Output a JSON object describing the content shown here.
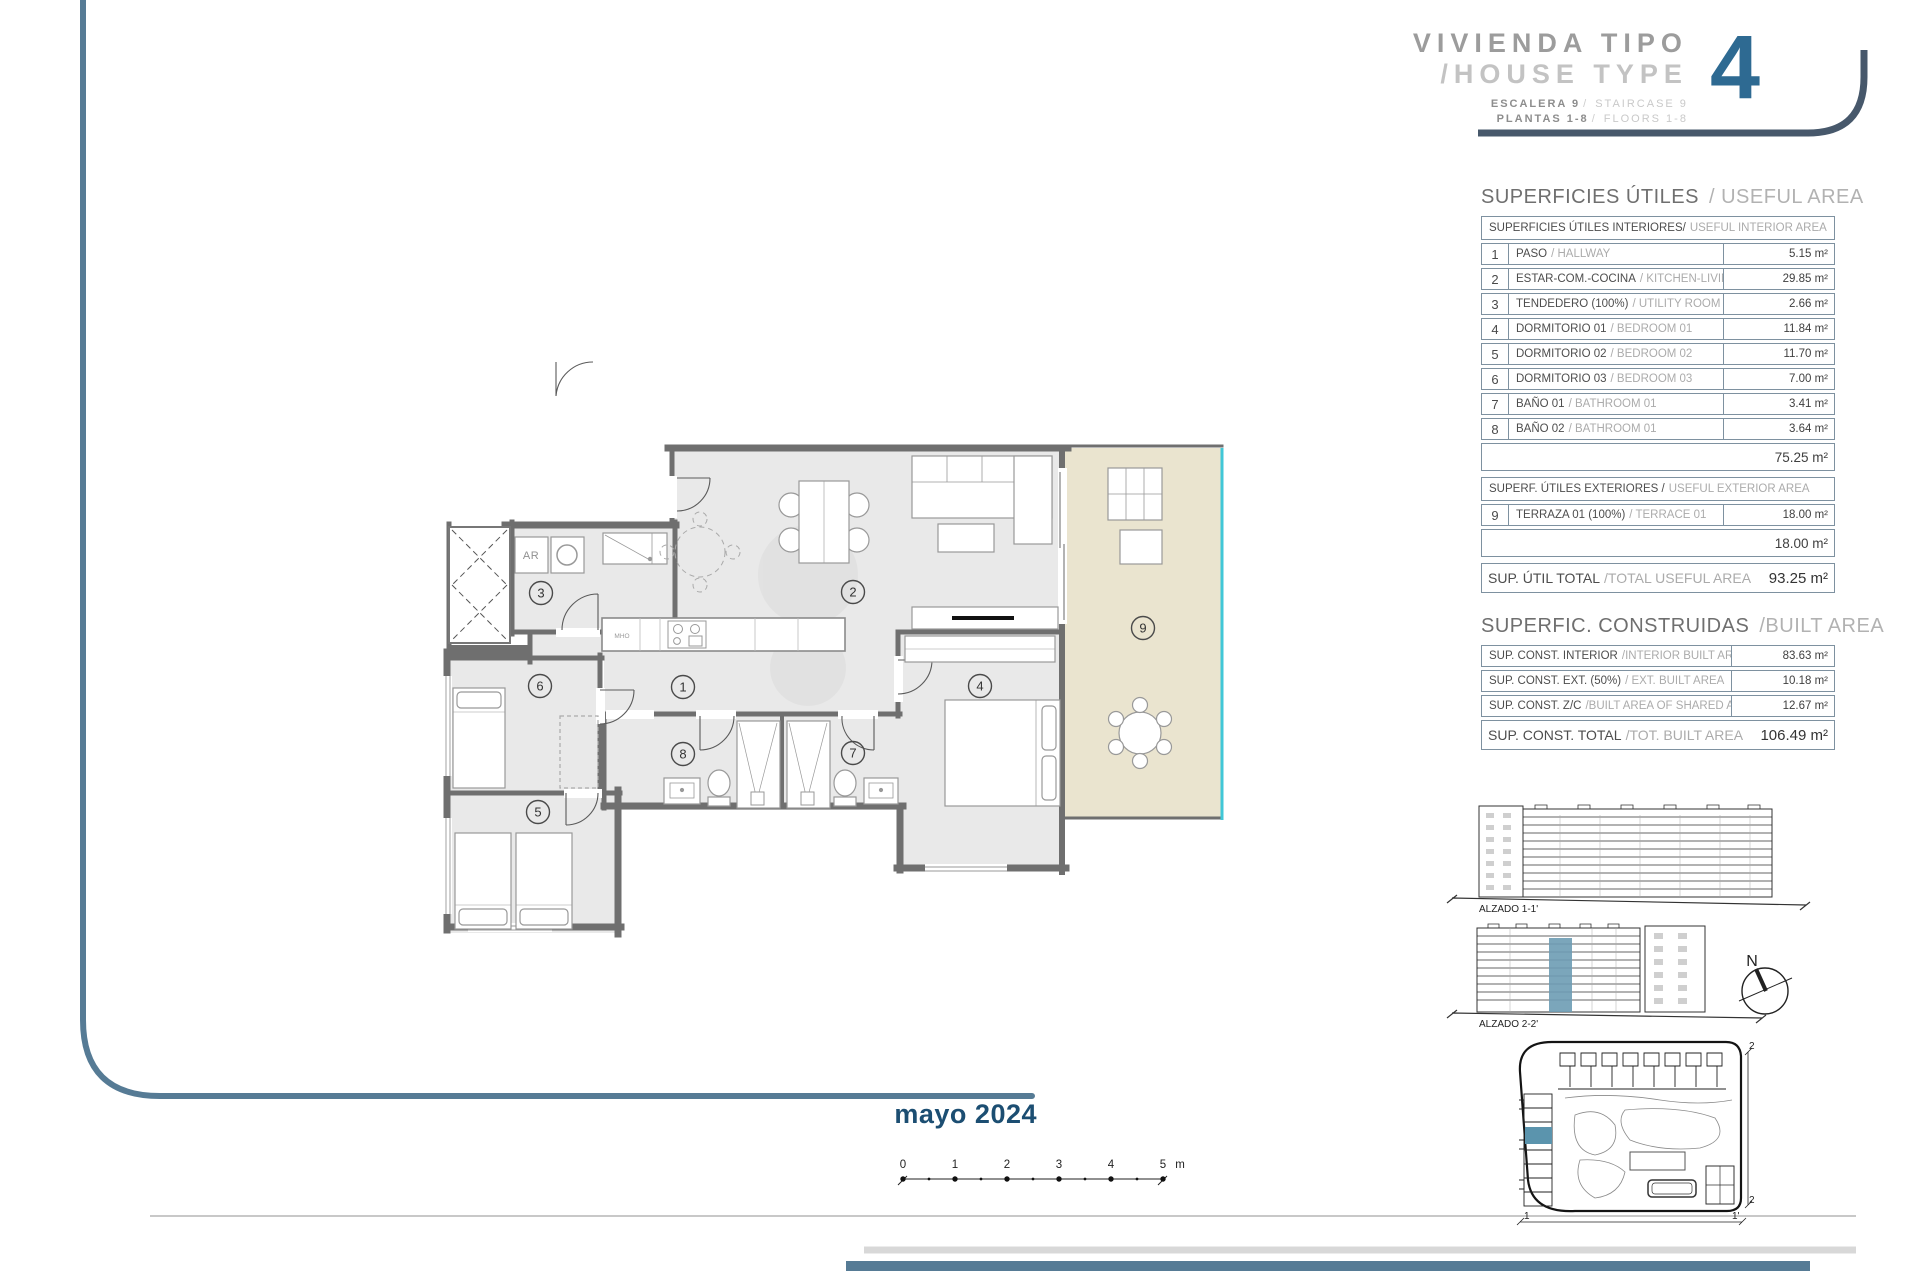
{
  "page": {
    "date": "mayo 2024"
  },
  "title_block": {
    "title_line1": "VIVIENDA TIPO",
    "title_line2": "/HOUSE TYPE",
    "type_number": "4",
    "sub_rows": [
      {
        "es": "ESCALERA 9",
        "en": "STAIRCASE 9"
      },
      {
        "es": "PLANTAS 1-8",
        "en": "FLOORS 1-8"
      }
    ]
  },
  "useful_area": {
    "title_es": "SUPERFICIES ÚTILES ",
    "title_en": "/ USEFUL AREA",
    "interior_header_es": "SUPERFICIES ÚTILES INTERIORES/",
    "interior_header_en": " USEFUL INTERIOR AREA",
    "rows": [
      {
        "num": "1",
        "es": "PASO",
        "en": "/ HALLWAY",
        "value": "5.15 m²"
      },
      {
        "num": "2",
        "es": "ESTAR-COM.-COCINA",
        "en": "/ KITCHEN-LIVING",
        "value": "29.85 m²"
      },
      {
        "num": "3",
        "es": "TENDEDERO (100%)",
        "en": "/ UTILITY ROOM",
        "value": "2.66 m²"
      },
      {
        "num": "4",
        "es": "DORMITORIO 01",
        "en": "/ BEDROOM 01",
        "value": "11.84 m²"
      },
      {
        "num": "5",
        "es": "DORMITORIO 02",
        "en": "/ BEDROOM 02",
        "value": "11.70 m²"
      },
      {
        "num": "6",
        "es": "DORMITORIO 03",
        "en": "/ BEDROOM 03",
        "value": "7.00 m²"
      },
      {
        "num": "7",
        "es": "BAÑO 01",
        "en": "/ BATHROOM 01",
        "value": "3.41 m²"
      },
      {
        "num": "8",
        "es": "BAÑO 02",
        "en": "/ BATHROOM 01",
        "value": "3.64 m²"
      }
    ],
    "interior_subtotal": "75.25 m²",
    "exterior_header_es": "SUPERF. ÚTILES EXTERIORES /",
    "exterior_header_en": " USEFUL EXTERIOR AREA",
    "exterior_rows": [
      {
        "num": "9",
        "es": "TERRAZA 01 (100%)",
        "en": "/ TERRACE 01",
        "value": "18.00 m²"
      }
    ],
    "exterior_subtotal": "18.00 m²",
    "total_es": "SUP. ÚTIL TOTAL",
    "total_en": "/TOTAL USEFUL AREA",
    "total_value": "93.25 m²"
  },
  "built_area": {
    "title_es": "SUPERFIC. CONSTRUIDAS ",
    "title_en": "/BUILT AREA",
    "rows": [
      {
        "es": "SUP. CONST. INTERIOR",
        "en": "/INTERIOR BUILT AREA",
        "value": "83.63 m²"
      },
      {
        "es": "SUP. CONST. EXT. (50%)",
        "en": "/ EXT. BUILT AREA",
        "value": "10.18 m²"
      },
      {
        "es": "SUP. CONST. Z/C",
        "en": "/BUILT AREA OF SHARED AREAS",
        "value": "12.67 m²"
      }
    ],
    "total_es": "SUP. CONST. TOTAL",
    "total_en": "/TOT. BUILT AREA",
    "total_value": "106.49 m²"
  },
  "floor_plan": {
    "room_numbers": [
      "1",
      "2",
      "3",
      "4",
      "5",
      "6",
      "7",
      "8",
      "9"
    ],
    "labels": {
      "closet": "AR",
      "kitchen_small": "MHO"
    },
    "floor_color": "#e9e9e9",
    "terrace_color": "#eae4cf",
    "wall_color": "#6f6f6f",
    "terrace_edge_color": "#41c7d7"
  },
  "elevations": {
    "label1": "ALZADO 1-1'",
    "label2": "ALZADO 2-2'",
    "highlight_color": "#6d9cb4"
  },
  "north_label": "N",
  "scale_bar": {
    "ticks": [
      "0",
      "1",
      "2",
      "3",
      "4",
      "5"
    ],
    "unit": "m"
  },
  "site_plan": {
    "marker_top": "2",
    "marker_bottom": "2",
    "marker_left": "1",
    "marker_right": "1'",
    "highlight_color": "#5b94ad"
  },
  "colors": {
    "accent_blue": "#2e6a92",
    "line_blue": "#567b95",
    "dark_slate": "#47586b",
    "date_blue": "#1c4e72"
  }
}
